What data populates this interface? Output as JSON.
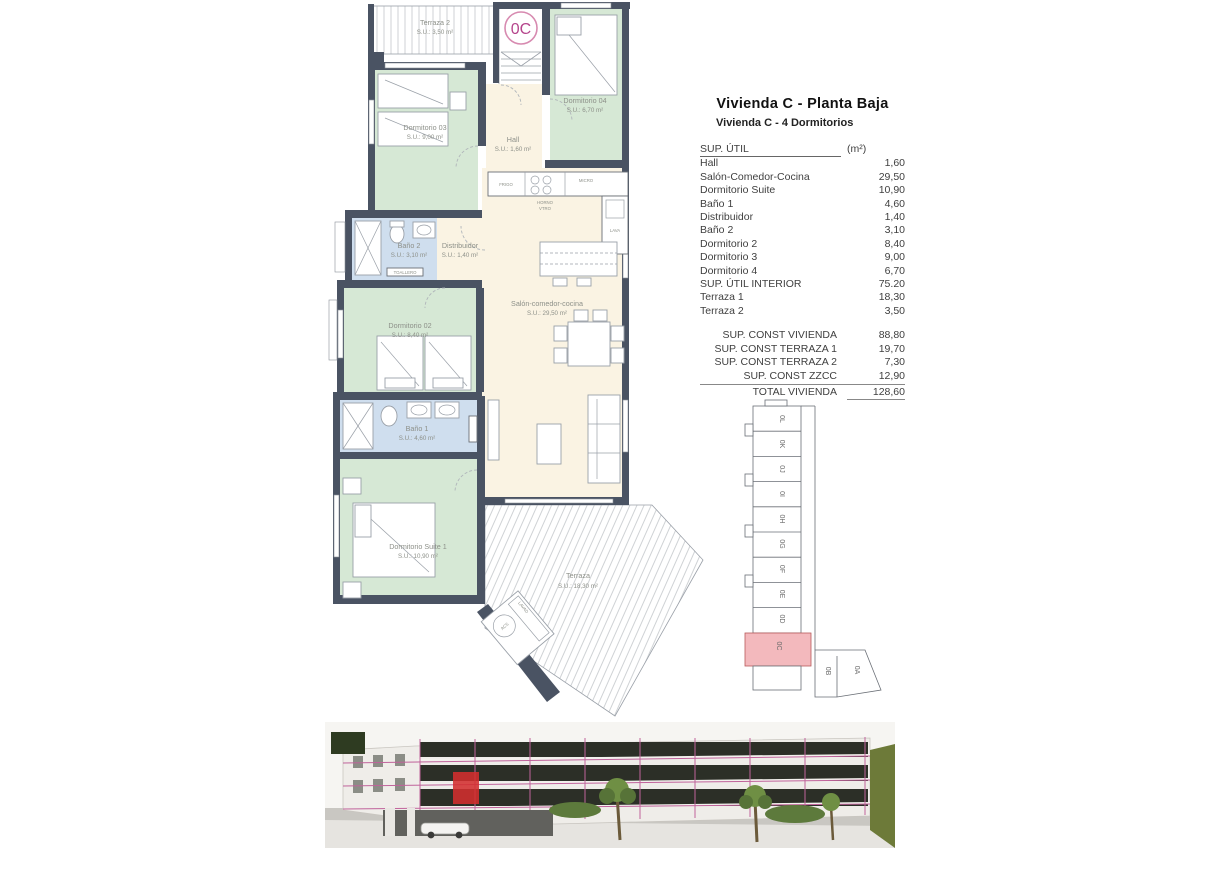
{
  "header": {
    "title": "Vivienda C - Planta Baja",
    "subtitle": "Vivienda C - 4 Dormitorios"
  },
  "area_table": {
    "header": {
      "label": "SUP. ÚTIL",
      "unit": "(m²)"
    },
    "rows": [
      {
        "label": "Hall",
        "value": "1,60"
      },
      {
        "label": "Salón-Comedor-Cocina",
        "value": "29,50"
      },
      {
        "label": "Dormitorio Suite",
        "value": "10,90"
      },
      {
        "label": "Baño 1",
        "value": "4,60"
      },
      {
        "label": "Distribuidor",
        "value": "1,40"
      },
      {
        "label": "Baño 2",
        "value": "3,10"
      },
      {
        "label": "Dormitorio 2",
        "value": "8,40"
      },
      {
        "label": "Dormitorio 3",
        "value": "9,00"
      },
      {
        "label": "Dormitorio 4",
        "value": "6,70"
      },
      {
        "label": "SUP. ÚTIL INTERIOR",
        "value": "75.20"
      },
      {
        "label": "Terraza 1",
        "value": "18,30"
      },
      {
        "label": "Terraza 2",
        "value": "3,50"
      }
    ],
    "summary_rows": [
      {
        "label": "SUP. CONST VIVIENDA",
        "value": "88,80"
      },
      {
        "label": "SUP. CONST TERRAZA 1",
        "value": "19,70"
      },
      {
        "label": "SUP. CONST TERRAZA 2",
        "value": "7,30"
      },
      {
        "label": "SUP. CONST ZZCC",
        "value": "12,90"
      }
    ],
    "total_row": {
      "label": "TOTAL VIVIENDA",
      "value": "128,60"
    }
  },
  "floor_plan": {
    "unit_label": "0C",
    "rooms": {
      "terraza2": {
        "name": "Terraza 2",
        "area": "S.U.: 3,50 m²"
      },
      "dorm3": {
        "name": "Dormitorio 03",
        "area": "S.U.: 9,00 m²"
      },
      "dorm4": {
        "name": "Dormitorio 04",
        "area": "S.U.: 6,70 m²"
      },
      "hall": {
        "name": "Hall",
        "area": "S.U.: 1,60 m²"
      },
      "bano2": {
        "name": "Baño 2",
        "area": "S.U.: 3,10 m²"
      },
      "distribuidor": {
        "name": "Distribuidor",
        "area": "S.U.: 1,40 m²"
      },
      "dorm2": {
        "name": "Dormitorio 02",
        "area": "S.U.: 8,40 m²"
      },
      "salon": {
        "name": "Salón-comedor-cocina",
        "area": "S.U.: 29,50 m²"
      },
      "bano1": {
        "name": "Baño 1",
        "area": "S.U.: 4,60 m²"
      },
      "suite": {
        "name": "Dormitorio Suite 1",
        "area": "S.U.: 10,90 m²"
      },
      "terraza": {
        "name": "Terraza",
        "area": "S.U.: 18,30 m²"
      }
    },
    "fixtures": {
      "frigo": "FRIGO",
      "horno": "HORNO",
      "vtro": "VTRO",
      "micro": "MICRO",
      "lava": "LAVA",
      "toallero": "TOALLERO",
      "acs": "ACS",
      "lavad": "LAVAD"
    }
  },
  "key_plan": {
    "units": [
      "0L",
      "0K",
      "0J",
      "0I",
      "0H",
      "0G",
      "0F",
      "0E",
      "0D",
      "0C",
      "0B",
      "0A"
    ],
    "highlighted_unit": "0C"
  },
  "colors": {
    "accent_pink": "#c2558f",
    "highlight_unit": "#f3b9bd",
    "elevation_highlight_red": "#d32f2f",
    "room_green": "#d6e8d5",
    "room_blue": "#cfdeee",
    "room_cream": "#faf3e3",
    "wall": "#4a5363"
  }
}
